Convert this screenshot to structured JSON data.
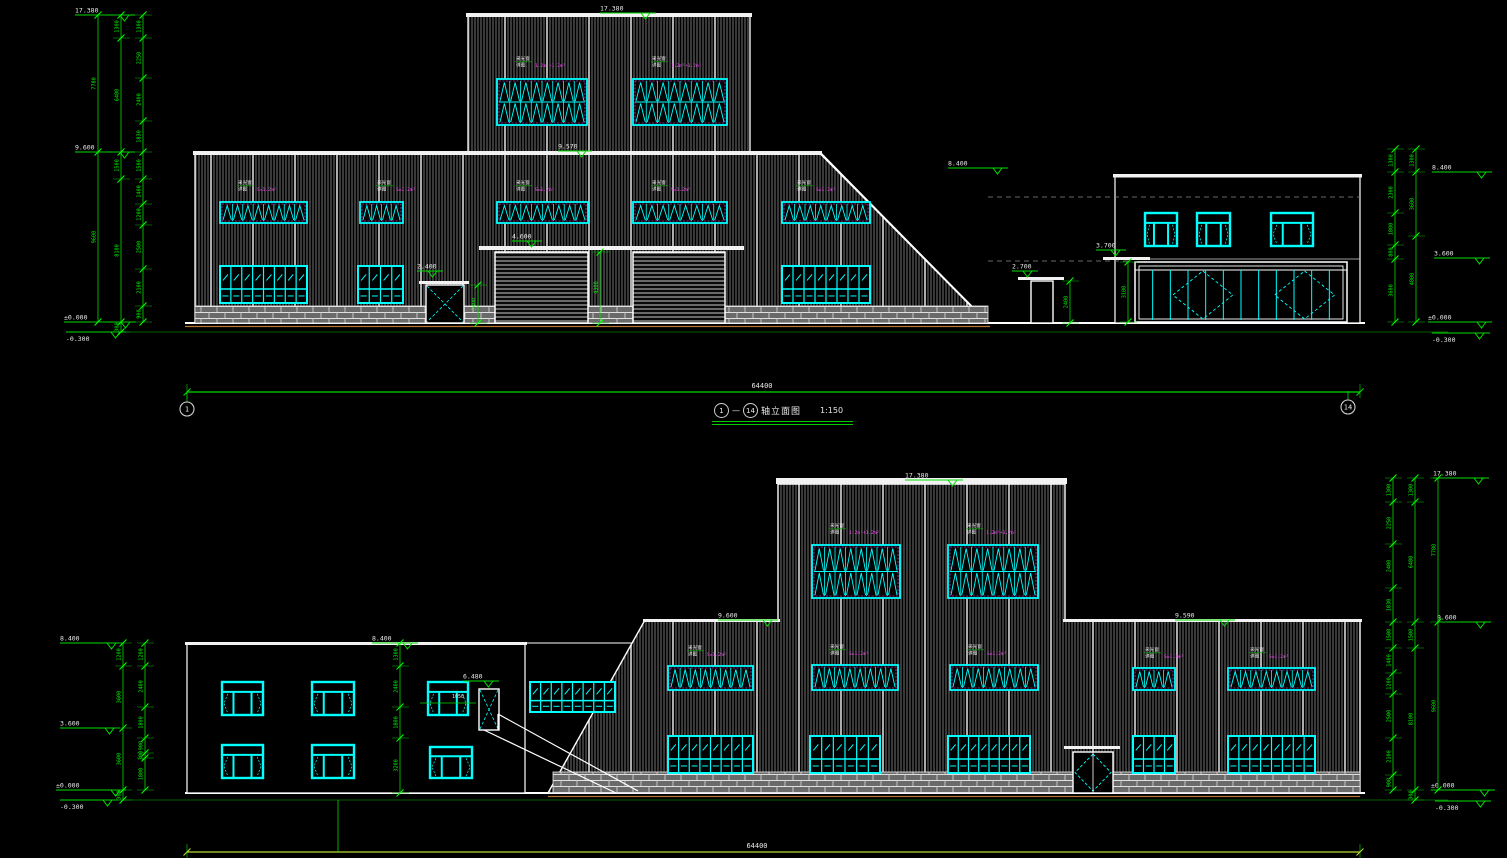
{
  "meta": {
    "width": 1507,
    "height": 858,
    "background": "#000000"
  },
  "colors": {
    "dim_line": "#00dd00",
    "dim_text": "#00ff00",
    "level_text": "#e8e8e8",
    "wall_outline": "#ffffff",
    "hatch_line": "#8f8f8f",
    "window_frame": "#00ffff",
    "window_accent": "#ff44ff",
    "ground_accent": "#b5762f",
    "overall_dim_bottom": "#b8d832",
    "projection_dash": "#8a8a8a"
  },
  "title": {
    "axis_from": "1",
    "axis_to": "14",
    "label": "轴立面图",
    "scale": "1:150"
  },
  "window_tag": {
    "l1": "采光窗",
    "l2": "详图"
  },
  "elev1": {
    "overall_dim": "64400",
    "items": [
      [
        "line",
        185,
        323,
        1365,
        323,
        "#ffffff",
        2,
        null
      ],
      [
        "line",
        185,
        326.5,
        990,
        326.5,
        "#b5762f",
        1.2,
        null
      ],
      [
        "line",
        95,
        332,
        1448,
        332,
        "#00bb00",
        0.6,
        null
      ],
      [
        "poly",
        [
          [
            195,
            152
          ],
          [
            820,
            152
          ],
          [
            988,
            323
          ],
          [
            195,
            323
          ]
        ],
        "hatch",
        1.3
      ],
      [
        "poly",
        [
          [
            468,
            14
          ],
          [
            750,
            14
          ],
          [
            750,
            152
          ],
          [
            468,
            152
          ]
        ],
        "hatch",
        1.3
      ],
      [
        "band",
        466,
        13,
        286,
        4
      ],
      [
        "band",
        193,
        151,
        629,
        4
      ],
      [
        "line",
        820,
        153,
        988,
        323,
        "#ffffff",
        2,
        null
      ],
      [
        "brick",
        195,
        306,
        231,
        17
      ],
      [
        "brick",
        463,
        306,
        32,
        17
      ],
      [
        "brick",
        588,
        306,
        45,
        17
      ],
      [
        "brick",
        725,
        306,
        263,
        17
      ],
      [
        "louver",
        497,
        79,
        90,
        46,
        2
      ],
      [
        "louver",
        633,
        79,
        94,
        46,
        2
      ],
      [
        "tag",
        516,
        60,
        "1.2m²+1.2m²"
      ],
      [
        "tag",
        652,
        60,
        "1.2m²+1.2m²"
      ],
      [
        "louver",
        220,
        202,
        87,
        21,
        1
      ],
      [
        "louver",
        360,
        202,
        43,
        21,
        1
      ],
      [
        "louver",
        497,
        202,
        91,
        21,
        1
      ],
      [
        "louver",
        633,
        202,
        94,
        21,
        1
      ],
      [
        "louver",
        782,
        202,
        88,
        21,
        1
      ],
      [
        "tag",
        238,
        184,
        "S=1.2m²"
      ],
      [
        "tag",
        377,
        184,
        "S=1.2m²"
      ],
      [
        "tag",
        516,
        184,
        "S=1.2m²"
      ],
      [
        "tag",
        652,
        184,
        "S=1.2m²"
      ],
      [
        "tag",
        797,
        184,
        "S=1.2m²"
      ],
      [
        "pane",
        220,
        266,
        87,
        37,
        8
      ],
      [
        "pane",
        358,
        266,
        45,
        37,
        4
      ],
      [
        "pane",
        782,
        266,
        88,
        37,
        8
      ],
      [
        "band",
        479,
        246,
        265,
        4
      ],
      [
        "roller",
        495,
        252,
        93,
        71
      ],
      [
        "roller",
        633,
        252,
        92,
        71
      ],
      [
        "dimv",
        600,
        [
          252,
          323
        ],
        [
          "4300"
        ]
      ],
      [
        "lvl",
        512,
        241,
        "4.600",
        30,
        0
      ],
      [
        "band",
        419,
        281,
        50,
        3
      ],
      [
        "xdoor",
        426,
        285,
        38,
        38,
        "x"
      ],
      [
        "lvl",
        417,
        271,
        "2.400",
        26,
        0
      ],
      [
        "dimv",
        478,
        [
          285,
          323
        ],
        [
          "2400"
        ]
      ],
      [
        "lvl",
        558,
        151,
        "9.570",
        34,
        0
      ],
      [
        "lvl",
        600,
        13,
        "17.380",
        56,
        0
      ],
      [
        "lvl",
        948,
        168,
        "8.400",
        60,
        0
      ],
      [
        "poly",
        [
          [
            1115,
            175
          ],
          [
            1360,
            175
          ],
          [
            1360,
            323
          ],
          [
            1115,
            323
          ]
        ],
        "none",
        1.2
      ],
      [
        "band",
        1113,
        174,
        249,
        3.5
      ],
      [
        "line",
        988,
        197,
        1360,
        197,
        "#8a8a8a",
        0.8,
        "5,4"
      ],
      [
        "line",
        988,
        261,
        1132,
        261,
        "#8a8a8a",
        0.8,
        "5,4"
      ],
      [
        "line",
        1115,
        259,
        1360,
        259,
        "#cfcfcf",
        0.8,
        null
      ],
      [
        "pwin",
        1145,
        213,
        32,
        33
      ],
      [
        "pwin",
        1197,
        213,
        33,
        33
      ],
      [
        "pwin",
        1271,
        213,
        42,
        33
      ],
      [
        "glass",
        1135,
        262,
        212,
        60
      ],
      [
        "band",
        1018,
        277,
        46,
        3
      ],
      [
        "xdoor",
        1031,
        281,
        22,
        42,
        "plain"
      ],
      [
        "dimv",
        1070,
        [
          281,
          323
        ],
        [
          "2400"
        ]
      ],
      [
        "lvl",
        1012,
        271,
        "2.700",
        26,
        0
      ],
      [
        "band",
        1103,
        257,
        47,
        3
      ],
      [
        "lvl",
        1096,
        250,
        "3.700",
        30,
        0
      ],
      [
        "dimv",
        1128,
        [
          262,
          322
        ],
        [
          "3100"
        ]
      ],
      [
        "lvl",
        75,
        15,
        "17.380",
        60,
        0
      ],
      [
        "lvl",
        75,
        152,
        "9.600",
        60,
        0
      ],
      [
        "lvl",
        64,
        322,
        "±0.000",
        72,
        0
      ],
      [
        "lvl",
        66,
        332,
        "-0.300",
        60,
        1
      ],
      [
        "dimv",
        143,
        [
          15,
          38,
          78,
          121,
          152,
          179,
          204,
          225,
          269,
          306,
          322
        ],
        [
          "1300",
          "2250",
          "2400",
          "1830",
          "1500",
          "1400",
          "1200",
          "2500",
          "2100",
          "900"
        ]
      ],
      [
        "dimv",
        121,
        [
          15,
          38,
          152,
          179,
          322,
          332
        ],
        [
          "1300",
          "6480",
          "1500",
          "8100",
          "300"
        ]
      ],
      [
        "dimv",
        98,
        [
          15,
          152,
          322
        ],
        [
          "7780",
          "9600"
        ]
      ],
      [
        "lvl",
        1432,
        172,
        "8.400",
        60,
        0
      ],
      [
        "lvl",
        1434,
        258,
        "3.600",
        56,
        0
      ],
      [
        "lvl",
        1428,
        322,
        "±0.000",
        64,
        0
      ],
      [
        "lvl",
        1432,
        333,
        "-0.300",
        58,
        1
      ],
      [
        "dimv",
        1395,
        [
          149,
          172,
          213,
          245,
          259,
          322
        ],
        [
          "1300",
          "2300",
          "1800",
          "800",
          "3600"
        ]
      ],
      [
        "dimv",
        1416,
        [
          149,
          172,
          236,
          322
        ],
        [
          "1300",
          "3600",
          "4800"
        ]
      ],
      [
        "dimh",
        392,
        187,
        1360,
        "#00dd00"
      ],
      [
        "txt",
        762,
        388,
        "64400",
        "#e8e8e8",
        7,
        0,
        "middle"
      ],
      [
        "circ",
        187,
        409,
        7,
        "1"
      ],
      [
        "circ",
        1348,
        407,
        7,
        "14"
      ]
    ]
  },
  "elev2": {
    "overall_dim": "64400",
    "items": [
      [
        "line",
        185,
        793,
        1365,
        793,
        "#ffffff",
        2,
        null
      ],
      [
        "line",
        548,
        796.5,
        1360,
        796.5,
        "#b5762f",
        1.2,
        null
      ],
      [
        "line",
        95,
        800,
        1448,
        800,
        "#00bb00",
        0.6,
        null
      ],
      [
        "poly",
        [
          [
            548,
            793
          ],
          [
            645,
            620
          ],
          [
            778,
            620
          ],
          [
            778,
            484
          ],
          [
            1065,
            484
          ],
          [
            1065,
            620
          ],
          [
            1360,
            620
          ],
          [
            1360,
            793
          ]
        ],
        "hatch",
        1.4
      ],
      [
        "band",
        776,
        478,
        291,
        6
      ],
      [
        "band",
        643,
        619,
        137,
        3
      ],
      [
        "band",
        1063,
        619,
        299,
        3
      ],
      [
        "brick",
        553,
        772,
        520,
        21
      ],
      [
        "brick",
        1113,
        772,
        247,
        21
      ],
      [
        "louver",
        812,
        545,
        88,
        53,
        2
      ],
      [
        "louver",
        948,
        545,
        90,
        53,
        2
      ],
      [
        "tag",
        830,
        527,
        "1.2m²+1.2m²"
      ],
      [
        "tag",
        967,
        527,
        "1.2m²+1.2m²"
      ],
      [
        "louver",
        668,
        666,
        85,
        24,
        1
      ],
      [
        "louver",
        812,
        665,
        86,
        25,
        1
      ],
      [
        "louver",
        950,
        665,
        88,
        25,
        1
      ],
      [
        "louver",
        1133,
        668,
        42,
        22,
        1
      ],
      [
        "louver",
        1228,
        668,
        87,
        22,
        1
      ],
      [
        "tag",
        688,
        649,
        "S=1.2m²"
      ],
      [
        "tag",
        830,
        648,
        "S=1.2m²"
      ],
      [
        "tag",
        968,
        648,
        "S=1.2m²"
      ],
      [
        "tag",
        1145,
        651,
        "S=1.2m²"
      ],
      [
        "tag",
        1250,
        651,
        "S=1.2m²"
      ],
      [
        "pane",
        668,
        736,
        85,
        37,
        8
      ],
      [
        "pane",
        810,
        736,
        70,
        37,
        6
      ],
      [
        "pane",
        948,
        736,
        82,
        37,
        8
      ],
      [
        "pane",
        1133,
        736,
        42,
        37,
        4
      ],
      [
        "pane",
        1228,
        736,
        87,
        37,
        8
      ],
      [
        "band",
        1064,
        746,
        56,
        3
      ],
      [
        "xdoor",
        1073,
        752,
        40,
        41,
        "diamond"
      ],
      [
        "lvl",
        905,
        480,
        "17.380",
        58,
        0
      ],
      [
        "lvl",
        718,
        620,
        "9.600",
        60,
        0
      ],
      [
        "lvl",
        1175,
        620,
        "9.590",
        60,
        0
      ],
      [
        "poly",
        [
          [
            187,
            643
          ],
          [
            525,
            643
          ],
          [
            525,
            793
          ],
          [
            187,
            793
          ]
        ],
        "none",
        1.2
      ],
      [
        "band",
        185,
        642,
        342,
        3
      ],
      [
        "line",
        525,
        643,
        632,
        643,
        "#ffffff",
        1,
        null
      ],
      [
        "pwin",
        222,
        682,
        41,
        33
      ],
      [
        "pwin",
        312,
        682,
        42,
        33
      ],
      [
        "pwin",
        428,
        682,
        40,
        33
      ],
      [
        "pwin",
        222,
        745,
        41,
        33
      ],
      [
        "pwin",
        312,
        745,
        42,
        33
      ],
      [
        "pwin",
        430,
        747,
        42,
        31
      ],
      [
        "lvl",
        60,
        643,
        "8.400",
        62,
        0
      ],
      [
        "lvl",
        372,
        643,
        "8.400",
        46,
        0
      ],
      [
        "dimv",
        400,
        [
          643,
          666,
          707,
          738,
          793
        ],
        [
          "1300",
          "2400",
          "1800",
          "3200"
        ]
      ],
      [
        "lvl",
        60,
        728,
        "3.600",
        60,
        0
      ],
      [
        "lvl",
        56,
        790,
        "±0.000",
        70,
        0
      ],
      [
        "lvl",
        60,
        800,
        "-0.300",
        58,
        1
      ],
      [
        "dimv",
        145,
        [
          643,
          666,
          707,
          738,
          753,
          758,
          790
        ],
        [
          "1200",
          "2400",
          "1800",
          "900",
          "300",
          "1800"
        ]
      ],
      [
        "dimv",
        123,
        [
          643,
          666,
          728,
          790,
          800
        ],
        [
          "1200",
          "3600",
          "3600",
          "300"
        ]
      ],
      [
        "xdoor",
        479,
        689,
        20,
        41,
        "x"
      ],
      [
        "lvl",
        463,
        681,
        "6.480",
        36,
        0
      ],
      [
        "txt",
        452,
        698,
        "1050",
        "#e8e8e8",
        5,
        0,
        "start"
      ],
      [
        "line",
        420,
        703,
        476,
        703,
        "#00dd00",
        0.8,
        null
      ],
      [
        "strip",
        530,
        682,
        85,
        30,
        8
      ],
      [
        "line",
        479,
        730,
        498,
        730,
        "#ffffff",
        1,
        null
      ],
      [
        "stair",
        [
          [
            498,
            714
          ],
          [
            638,
            791
          ]
        ]
      ],
      [
        "stair",
        [
          [
            484,
            730
          ],
          [
            616,
            793
          ]
        ]
      ],
      [
        "stair",
        [
          [
            498,
            730
          ],
          [
            498,
            714
          ]
        ]
      ],
      [
        "lvl",
        1433,
        478,
        "17.380",
        56,
        0
      ],
      [
        "lvl",
        1437,
        622,
        "9.600",
        54,
        0
      ],
      [
        "lvl",
        1431,
        790,
        "±0.000",
        64,
        0
      ],
      [
        "lvl",
        1435,
        801,
        "-0.300",
        56,
        1
      ],
      [
        "dimv",
        1393,
        [
          478,
          502,
          544,
          588,
          622,
          648,
          673,
          694,
          738,
          775,
          790
        ],
        [
          "1300",
          "2250",
          "2400",
          "1830",
          "1500",
          "1400",
          "1200",
          "2500",
          "2100",
          "900"
        ]
      ],
      [
        "dimv",
        1415,
        [
          478,
          502,
          622,
          648,
          790,
          800
        ],
        [
          "1300",
          "6480",
          "1500",
          "8100",
          "300"
        ]
      ],
      [
        "dimv",
        1438,
        [
          478,
          622,
          790
        ],
        [
          "7780",
          "9600"
        ]
      ],
      [
        "dimh",
        852,
        187,
        1360,
        "#b8d832"
      ],
      [
        "txt",
        757,
        848,
        "64400",
        "#e8e8e8",
        7,
        0,
        "middle"
      ],
      [
        "line",
        338,
        800,
        338,
        852,
        "#00dd00",
        0.8,
        null
      ]
    ]
  }
}
